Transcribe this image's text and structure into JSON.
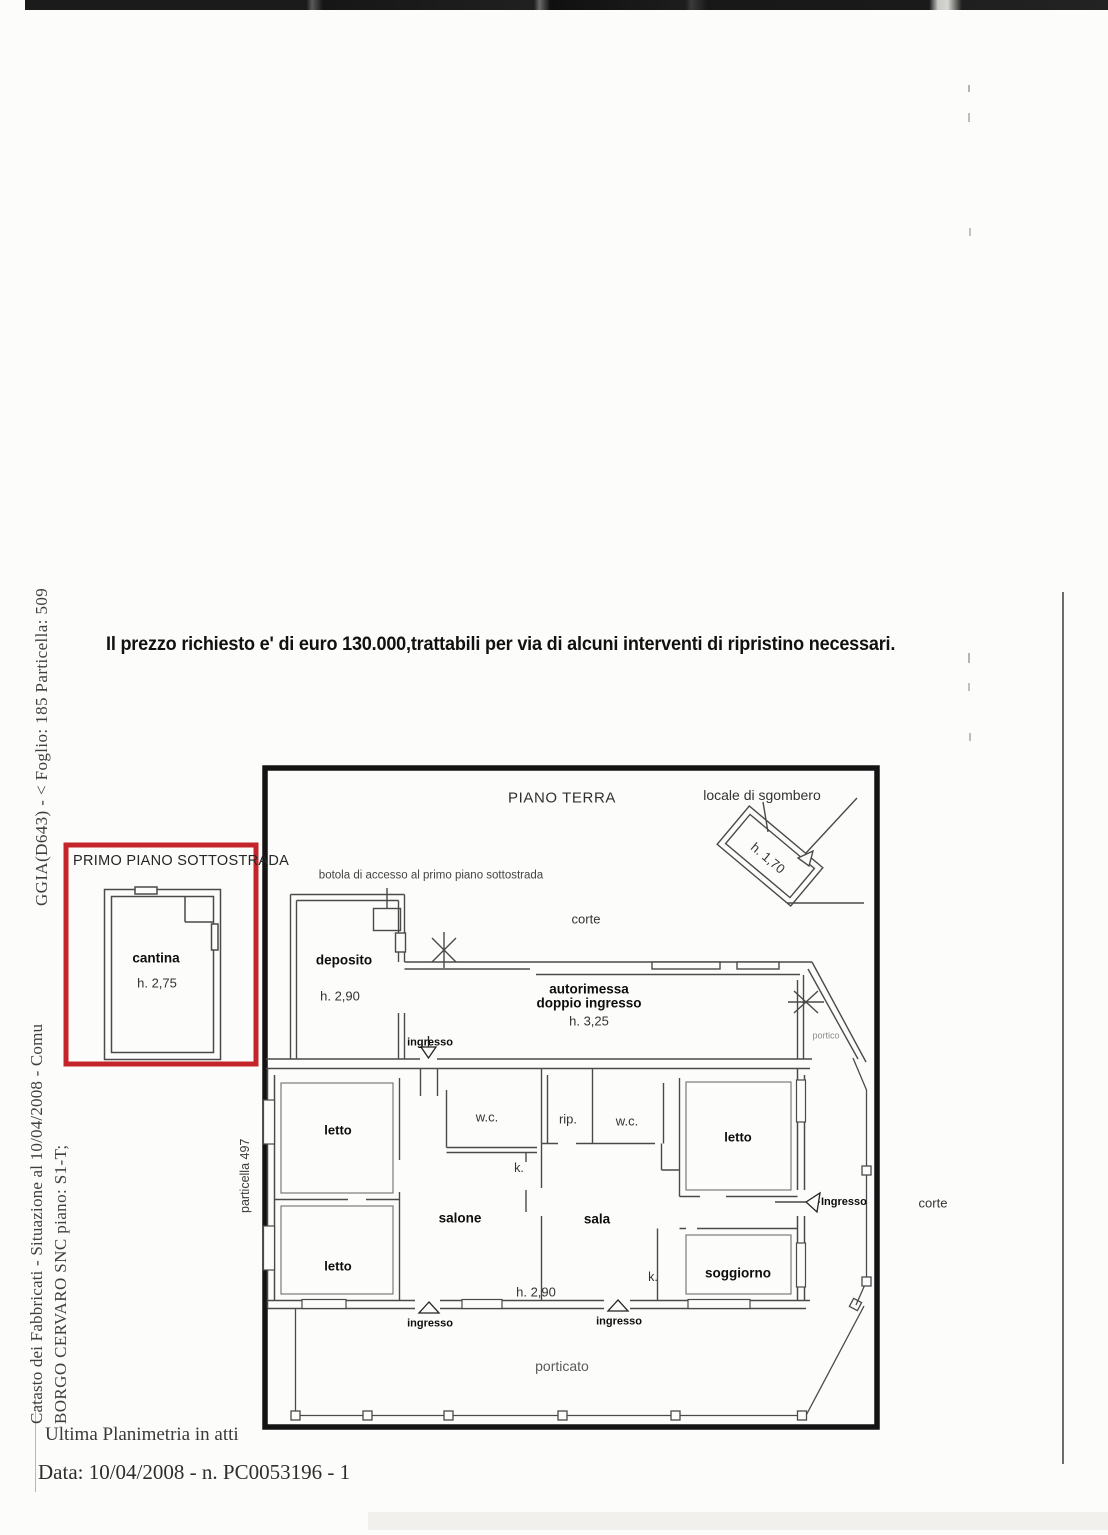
{
  "document": {
    "price_line": "Il prezzo richiesto e' di euro 130.000,trattabili per via di alcuni interventi di ripristino necessari.",
    "margin_text": {
      "cadastral_ref": "GGIA(D643) - < Foglio: 185 Particella: 509",
      "cadastral_situation": "Catasto dei Fabbricati - Situazione al 10/04/2008 - Comu",
      "address_line": "BORGO CERVARO SNC piano: S1-T;",
      "particella": "particella 497"
    },
    "footer": {
      "planimetria_note": "Ultima Planimetria in atti",
      "date_line": "Data: 10/04/2008 -  n. PC0053196 - 1"
    }
  },
  "floorplan": {
    "title": "PIANO TERRA",
    "basement_box": {
      "title": "PRIMO PIANO SOTTOSTRADA",
      "room": "cantina",
      "room_height": "h. 2,75"
    },
    "labels": {
      "locale_sgombero": "locale di sgombero",
      "locale_sgombero_height": "h. 1,70",
      "botola": "botola di accesso al primo piano sottostrada",
      "corte_top": "corte",
      "deposito": "deposito",
      "deposito_height": "h. 2,90",
      "autorimessa_line1": "autorimessa",
      "autorimessa_line2": "doppio ingresso",
      "autorimessa_height": "h. 3,25",
      "portico": "portico",
      "ingresso_top": "ingresso",
      "letto_top_left": "letto",
      "wc_left": "w.c.",
      "rip": "rip.",
      "wc_center": "w.c.",
      "letto_top_right": "letto",
      "k_left": "k.",
      "salone": "salone",
      "sala": "sala",
      "letto_bottom_left": "letto",
      "k_right": "k.",
      "soggiorno": "soggiorno",
      "interior_height": "h. 2,90",
      "ingresso_right": "Ingresso",
      "ingresso_bottom_left": "ingresso",
      "ingresso_bottom_center": "ingresso",
      "porticato": "porticato",
      "corte_right": "corte"
    }
  },
  "colors": {
    "highlight_red": "#c4252b",
    "ink": "#4a4a4a",
    "border_black": "#141414"
  }
}
